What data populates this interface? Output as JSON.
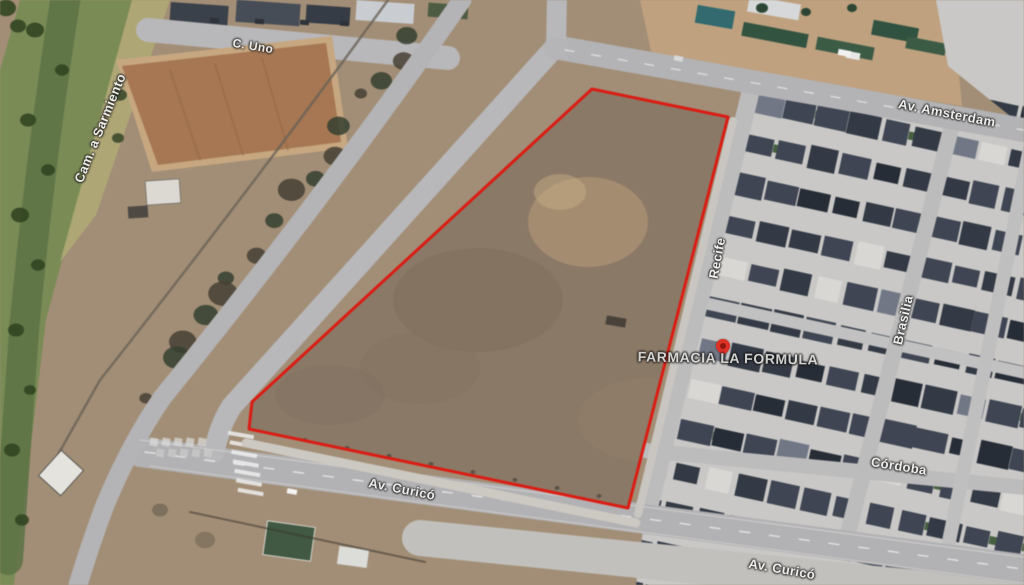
{
  "map": {
    "view": "satellite",
    "parcel": {
      "outline_color": "#e8190f",
      "points": "592,89 728,117 628,508 249,429 252,402"
    },
    "poi": {
      "name": "FARMACIA LA FORMULA",
      "pin_color": "#dd3125",
      "pin_x": 716,
      "pin_y": 339,
      "label_x": 728,
      "label_y": 358
    },
    "street_labels": [
      {
        "id": "cam-a-sarmiento",
        "text": "Cam. a Sarmiento",
        "x": 100,
        "y": 128,
        "rot": -68,
        "size": 13
      },
      {
        "id": "c-uno",
        "text": "C. Uno",
        "x": 253,
        "y": 46,
        "rot": 9,
        "size": 12
      },
      {
        "id": "av-amsterdam",
        "text": "Av. Amsterdam",
        "x": 947,
        "y": 113,
        "rot": 11,
        "size": 13
      },
      {
        "id": "recife",
        "text": "Recife",
        "x": 717,
        "y": 258,
        "rot": -79,
        "size": 13
      },
      {
        "id": "brasilia",
        "text": "Brasilia",
        "x": 903,
        "y": 320,
        "rot": -77,
        "size": 13
      },
      {
        "id": "cordoba",
        "text": "Córdoba",
        "x": 899,
        "y": 466,
        "rot": 9,
        "size": 13
      },
      {
        "id": "av-curico-west",
        "text": "Av. Curicó",
        "x": 402,
        "y": 489,
        "rot": 11,
        "size": 13
      },
      {
        "id": "av-curico-east",
        "text": "Av. Curicó",
        "x": 782,
        "y": 569,
        "rot": 10,
        "size": 13
      }
    ],
    "colors": {
      "terrain": "#a38e74",
      "parcel_fill": "#8c7965",
      "road": "#b6b5b7",
      "neighborhood_base": "#c9c8c6",
      "roof_dark": "#333a46",
      "vegetation": "#7a8c52",
      "field_orange": "#a9764e"
    }
  }
}
